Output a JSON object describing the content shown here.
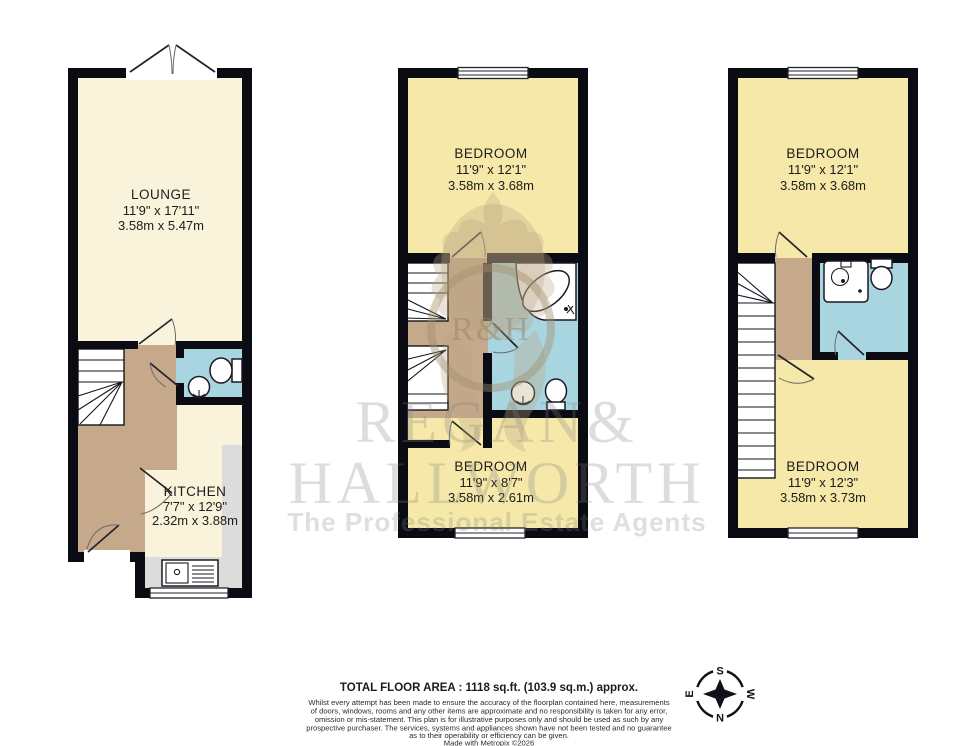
{
  "watermark": {
    "brand_top": "REGAN&",
    "brand_bottom": "HALLWORTH",
    "tagline": "The Professional Estate Agents",
    "monogram": "R&H"
  },
  "plans": [
    {
      "name": "ground-floor",
      "rooms": [
        {
          "name": "LOUNGE",
          "imperial": "11'9\" x 17'11\"",
          "metric": "3.58m x 5.47m"
        },
        {
          "name": "KITCHEN",
          "imperial": "7'7\" x 12'9\"",
          "metric": "2.32m x 3.88m"
        }
      ],
      "fixtures": [
        "french-doors",
        "winder-stairs",
        "wc-toilet",
        "wc-basin",
        "kitchen-counter",
        "kitchen-sink",
        "window"
      ]
    },
    {
      "name": "first-floor",
      "rooms": [
        {
          "name": "BEDROOM",
          "imperial": "11'9\" x 12'1\"",
          "metric": "3.58m x 3.68m"
        },
        {
          "name": "BEDROOM",
          "imperial": "11'9\" x 8'7\"",
          "metric": "3.58m x 2.61m"
        }
      ],
      "fixtures": [
        "stairs-up",
        "stairs-down",
        "corner-bath",
        "basin",
        "toilet",
        "windows"
      ]
    },
    {
      "name": "second-floor",
      "rooms": [
        {
          "name": "BEDROOM",
          "imperial": "11'9\" x 12'1\"",
          "metric": "3.58m x 3.68m"
        },
        {
          "name": "BEDROOM",
          "imperial": "11'9\" x 12'3\"",
          "metric": "3.58m x 3.73m"
        }
      ],
      "fixtures": [
        "stairs",
        "shower",
        "toilet",
        "windows"
      ]
    }
  ],
  "footer": {
    "total_area": "TOTAL FLOOR AREA : 1118 sq.ft. (103.9 sq.m.) approx.",
    "disclaimer_lines": [
      "Whilst every attempt has been made to ensure the accuracy of the floorplan contained here, measurements",
      "of doors, windows, rooms and any other items are approximate and no responsibility is taken for any error,",
      "omission or mis-statement. This plan is for illustrative purposes only and should be used as such by any",
      "prospective purchaser. The services, systems and appliances shown have not been tested and no guarantee",
      "as to their operability or efficiency can be given.",
      "Made with Metropix ©2026"
    ]
  },
  "compass": {
    "north": "N",
    "south": "S",
    "east": "E",
    "west": "W"
  },
  "colors": {
    "wall": "#0b0b14",
    "room_cream": "#faf3dc",
    "room_yellow": "#f5e8a8",
    "hall_tan": "#c6a98b",
    "bath_blue": "#a9d5e0",
    "counter_grey": "#dcdcdc",
    "watermark_grey": "#d9d9d9",
    "crest_tan": "#d9cdb8"
  }
}
